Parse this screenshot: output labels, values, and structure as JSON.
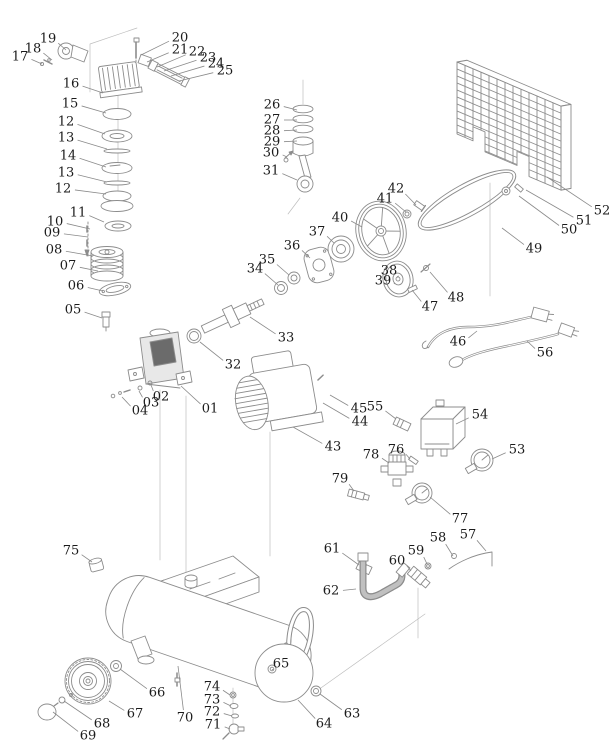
{
  "diagram": {
    "kind": "air-compressor-exploded-parts-diagram",
    "background": "#ffffff",
    "line_color": "#8c8c8c",
    "label_color": "#1b1b1b",
    "labels": [
      {
        "n": "19",
        "cx": 48,
        "cy": 39,
        "tx": 66,
        "ty": 50
      },
      {
        "n": "18",
        "cx": 33,
        "cy": 49,
        "tx": 52,
        "ty": 60
      },
      {
        "n": "17",
        "cx": 20,
        "cy": 57,
        "tx": 42,
        "ty": 64
      },
      {
        "n": "20",
        "cx": 180,
        "cy": 38,
        "tx": 141,
        "ty": 55
      },
      {
        "n": "21",
        "cx": 180,
        "cy": 50,
        "tx": 147,
        "ty": 62
      },
      {
        "n": "22",
        "cx": 197,
        "cy": 52,
        "tx": 157,
        "ty": 67
      },
      {
        "n": "23",
        "cx": 208,
        "cy": 58,
        "tx": 164,
        "ty": 71
      },
      {
        "n": "24",
        "cx": 216,
        "cy": 64,
        "tx": 171,
        "ty": 76
      },
      {
        "n": "25",
        "cx": 225,
        "cy": 71,
        "tx": 179,
        "ty": 81
      },
      {
        "n": "16",
        "cx": 71,
        "cy": 84,
        "tx": 103,
        "ty": 93
      },
      {
        "n": "15",
        "cx": 70,
        "cy": 104,
        "tx": 106,
        "ty": 113
      },
      {
        "n": "12",
        "cx": 66,
        "cy": 122,
        "tx": 105,
        "ty": 134
      },
      {
        "n": "13",
        "cx": 66,
        "cy": 138,
        "tx": 107,
        "ty": 149
      },
      {
        "n": "14",
        "cx": 68,
        "cy": 156,
        "tx": 106,
        "ty": 167
      },
      {
        "n": "13",
        "cx": 66,
        "cy": 173,
        "tx": 107,
        "ty": 182
      },
      {
        "n": "12",
        "cx": 63,
        "cy": 189,
        "tx": 106,
        "ty": 194
      },
      {
        "n": "11",
        "cx": 78,
        "cy": 213,
        "tx": 104,
        "ty": 222
      },
      {
        "n": "10",
        "cx": 55,
        "cy": 222,
        "tx": 90,
        "ty": 229
      },
      {
        "n": "09",
        "cx": 52,
        "cy": 233,
        "tx": 88,
        "ty": 237
      },
      {
        "n": "08",
        "cx": 54,
        "cy": 250,
        "tx": 93,
        "ty": 256
      },
      {
        "n": "07",
        "cx": 68,
        "cy": 266,
        "tx": 98,
        "ty": 271
      },
      {
        "n": "06",
        "cx": 76,
        "cy": 286,
        "tx": 103,
        "ty": 291
      },
      {
        "n": "05",
        "cx": 73,
        "cy": 310,
        "tx": 102,
        "ty": 318
      },
      {
        "n": "26",
        "cx": 272,
        "cy": 105,
        "tx": 297,
        "ty": 110
      },
      {
        "n": "27",
        "cx": 272,
        "cy": 120,
        "tx": 297,
        "ty": 120
      },
      {
        "n": "28",
        "cx": 272,
        "cy": 131,
        "tx": 297,
        "ty": 130
      },
      {
        "n": "29",
        "cx": 272,
        "cy": 142,
        "tx": 297,
        "ty": 141
      },
      {
        "n": "30",
        "cx": 271,
        "cy": 153,
        "tx": 287,
        "ty": 157
      },
      {
        "n": "31",
        "cx": 271,
        "cy": 171,
        "tx": 297,
        "ty": 180
      },
      {
        "n": "40",
        "cx": 340,
        "cy": 218,
        "tx": 362,
        "ty": 227
      },
      {
        "n": "41",
        "cx": 385,
        "cy": 199,
        "tx": 406,
        "ty": 212
      },
      {
        "n": "42",
        "cx": 396,
        "cy": 189,
        "tx": 416,
        "ty": 205
      },
      {
        "n": "37",
        "cx": 317,
        "cy": 232,
        "tx": 334,
        "ty": 243
      },
      {
        "n": "36",
        "cx": 292,
        "cy": 246,
        "tx": 310,
        "ty": 258
      },
      {
        "n": "35",
        "cx": 267,
        "cy": 260,
        "tx": 289,
        "ty": 275
      },
      {
        "n": "34",
        "cx": 255,
        "cy": 269,
        "tx": 278,
        "ty": 285
      },
      {
        "n": "38",
        "cx": 389,
        "cy": 271,
        "tx": 397,
        "ty": 277
      },
      {
        "n": "39",
        "cx": 383,
        "cy": 281,
        "tx": 394,
        "ty": 284
      },
      {
        "n": "33",
        "cx": 286,
        "cy": 338,
        "tx": 250,
        "ty": 317
      },
      {
        "n": "32",
        "cx": 233,
        "cy": 365,
        "tx": 200,
        "ty": 342
      },
      {
        "n": "47",
        "cx": 430,
        "cy": 307,
        "tx": 412,
        "ty": 290
      },
      {
        "n": "48",
        "cx": 456,
        "cy": 298,
        "tx": 430,
        "ty": 272
      },
      {
        "n": "49",
        "cx": 534,
        "cy": 249,
        "tx": 502,
        "ty": 228
      },
      {
        "n": "50",
        "cx": 569,
        "cy": 230,
        "tx": 519,
        "ty": 196
      },
      {
        "n": "51",
        "cx": 584,
        "cy": 221,
        "tx": 526,
        "ty": 190
      },
      {
        "n": "52",
        "cx": 602,
        "cy": 211,
        "tx": 547,
        "ty": 177
      },
      {
        "n": "46",
        "cx": 458,
        "cy": 342,
        "tx": 477,
        "ty": 331
      },
      {
        "n": "56",
        "cx": 545,
        "cy": 353,
        "tx": 527,
        "ty": 341
      },
      {
        "n": "01",
        "cx": 210,
        "cy": 409,
        "tx": 181,
        "ty": 386
      },
      {
        "n": "02",
        "cx": 161,
        "cy": 397,
        "tx": 151,
        "ty": 385
      },
      {
        "n": "03",
        "cx": 151,
        "cy": 403,
        "tx": 139,
        "ty": 391
      },
      {
        "n": "04",
        "cx": 140,
        "cy": 411,
        "tx": 122,
        "ty": 397
      },
      {
        "n": "43",
        "cx": 333,
        "cy": 447,
        "tx": 293,
        "ty": 427
      },
      {
        "n": "44",
        "cx": 360,
        "cy": 422,
        "tx": 323,
        "ty": 403
      },
      {
        "n": "45",
        "cx": 359,
        "cy": 409,
        "tx": 330,
        "ty": 395
      },
      {
        "n": "55",
        "cx": 375,
        "cy": 407,
        "tx": 396,
        "ty": 419
      },
      {
        "n": "54",
        "cx": 480,
        "cy": 415,
        "tx": 456,
        "ty": 424
      },
      {
        "n": "53",
        "cx": 517,
        "cy": 450,
        "tx": 492,
        "ty": 459
      },
      {
        "n": "76",
        "cx": 396,
        "cy": 450,
        "tx": 410,
        "ty": 459
      },
      {
        "n": "78",
        "cx": 371,
        "cy": 455,
        "tx": 389,
        "ty": 463
      },
      {
        "n": "79",
        "cx": 340,
        "cy": 479,
        "tx": 354,
        "ty": 491
      },
      {
        "n": "77",
        "cx": 460,
        "cy": 519,
        "tx": 430,
        "ty": 497
      },
      {
        "n": "57",
        "cx": 468,
        "cy": 535,
        "tx": 486,
        "ty": 551
      },
      {
        "n": "58",
        "cx": 438,
        "cy": 538,
        "tx": 453,
        "ty": 556
      },
      {
        "n": "59",
        "cx": 416,
        "cy": 551,
        "tx": 427,
        "ty": 564
      },
      {
        "n": "60",
        "cx": 397,
        "cy": 561,
        "tx": 411,
        "ty": 571
      },
      {
        "n": "61",
        "cx": 332,
        "cy": 549,
        "tx": 359,
        "ty": 565
      },
      {
        "n": "62",
        "cx": 331,
        "cy": 591,
        "tx": 356,
        "ty": 589
      },
      {
        "n": "75",
        "cx": 71,
        "cy": 551,
        "tx": 92,
        "ty": 562
      },
      {
        "n": "65",
        "cx": 281,
        "cy": 664,
        "tx": 274,
        "ty": 670
      },
      {
        "n": "63",
        "cx": 352,
        "cy": 714,
        "tx": 320,
        "ty": 694
      },
      {
        "n": "64",
        "cx": 324,
        "cy": 724,
        "tx": 298,
        "ty": 700
      },
      {
        "n": "66",
        "cx": 157,
        "cy": 693,
        "tx": 120,
        "ty": 669
      },
      {
        "n": "67",
        "cx": 135,
        "cy": 714,
        "tx": 109,
        "ty": 701
      },
      {
        "n": "68",
        "cx": 102,
        "cy": 724,
        "tx": 64,
        "ty": 701
      },
      {
        "n": "69",
        "cx": 88,
        "cy": 736,
        "tx": 53,
        "ty": 712
      },
      {
        "n": "70",
        "cx": 185,
        "cy": 718,
        "tx": 178,
        "ty": 666
      },
      {
        "n": "74",
        "cx": 212,
        "cy": 687,
        "tx": 230,
        "ty": 695
      },
      {
        "n": "73",
        "cx": 212,
        "cy": 700,
        "tx": 231,
        "ty": 706
      },
      {
        "n": "72",
        "cx": 212,
        "cy": 712,
        "tx": 232,
        "ty": 716
      },
      {
        "n": "71",
        "cx": 213,
        "cy": 725,
        "tx": 230,
        "ty": 729
      }
    ]
  }
}
